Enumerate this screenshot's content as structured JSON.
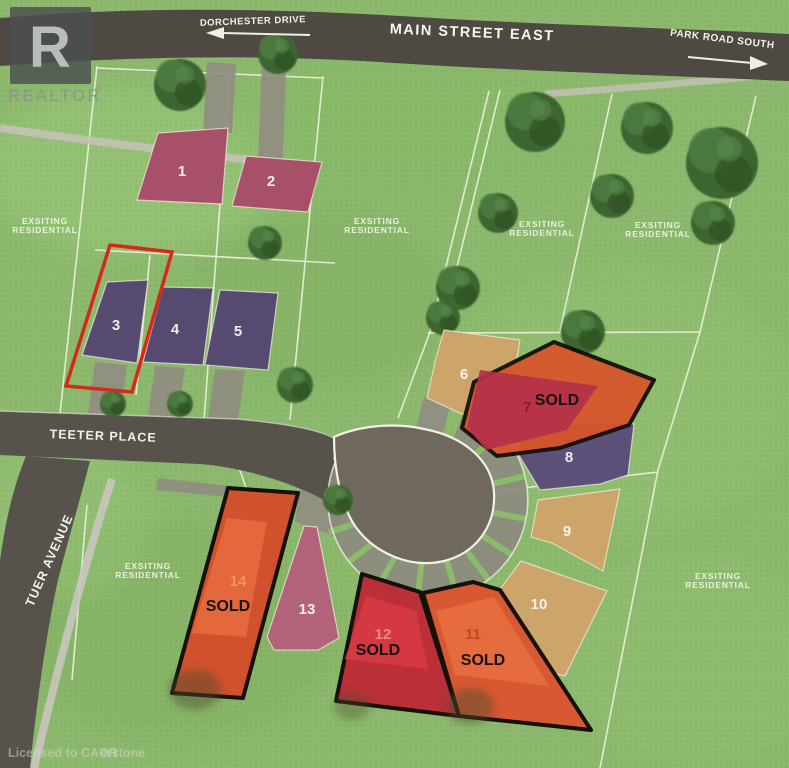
{
  "branding": {
    "logo_letter": "R",
    "logo_word": "REALTOR",
    "registered": "®"
  },
  "watermark": {
    "part1": "Licensed to CAOR",
    "part2": "erstone"
  },
  "streets": {
    "dorchester": {
      "label": "DORCHESTER DRIVE",
      "arrow": "left"
    },
    "main": {
      "label": "MAIN STREET EAST"
    },
    "park": {
      "label": "PARK ROAD SOUTH",
      "arrow": "right"
    },
    "teeter": {
      "label": "TEETER PLACE"
    },
    "tuer": {
      "label": "TUER AVENUE"
    }
  },
  "area_label": {
    "line1": "EXSITING",
    "line2": "RESIDENTIAL"
  },
  "sold_label": "SOLD",
  "colors": {
    "sold_outline": "#14100a",
    "highlight": "#d8281a",
    "road": "#4e4943",
    "local_road": "#57524b",
    "cul_de_sac": "#6f685c"
  },
  "highlight": {
    "lot_number": "3",
    "color": "#d8281a"
  },
  "lots": [
    {
      "number": "1",
      "fill": "#a8506a",
      "number_color": "#f2edf0",
      "sold": false
    },
    {
      "number": "2",
      "fill": "#a8506a",
      "number_color": "#f2edf0",
      "sold": false
    },
    {
      "number": "3",
      "fill": "#564a70",
      "number_color": "#f2edf0",
      "sold": false
    },
    {
      "number": "4",
      "fill": "#564a70",
      "number_color": "#f2edf0",
      "sold": false
    },
    {
      "number": "5",
      "fill": "#564a70",
      "number_color": "#f2edf0",
      "sold": false
    },
    {
      "number": "6",
      "fill": "#cda56a",
      "number_color": "#f7f3ea",
      "sold": false
    },
    {
      "number": "7",
      "fill": "#b5304a",
      "overlay_fill": "#d8552c",
      "number_color": "#8c1b2c",
      "sold": true
    },
    {
      "number": "8",
      "fill": "#5d5078",
      "number_color": "#f2edf0",
      "sold": false
    },
    {
      "number": "9",
      "fill": "#cda56a",
      "number_color": "#f7f3ea",
      "sold": false
    },
    {
      "number": "10",
      "fill": "#cda56a",
      "number_color": "#f7f3ea",
      "sold": false
    },
    {
      "number": "11",
      "fill": "#d85832",
      "inner_fill": "#e66b3e",
      "number_color": "#c2481b",
      "sold": true
    },
    {
      "number": "12",
      "fill": "#bb3038",
      "inner_fill": "#d63842",
      "number_color": "#ee8585",
      "sold": true
    },
    {
      "number": "13",
      "fill": "#b2637a",
      "number_color": "#f2edf0",
      "sold": false
    },
    {
      "number": "14",
      "fill": "#d0512c",
      "inner_fill": "#e5673c",
      "number_color": "#f0916f",
      "sold": true
    }
  ]
}
